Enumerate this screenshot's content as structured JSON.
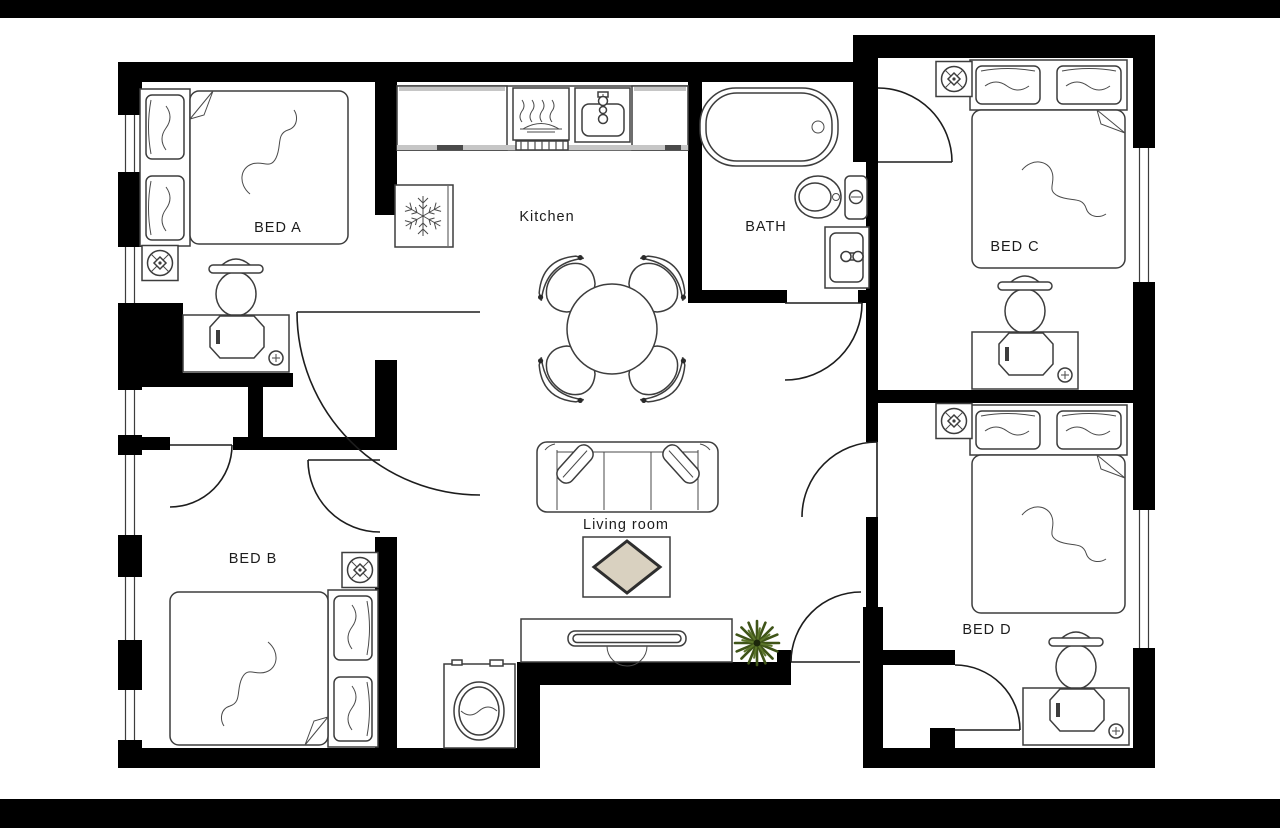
{
  "title": "Apartment floor plan",
  "rooms": {
    "bed_a": {
      "label": "BED A"
    },
    "bed_b": {
      "label": "BED B"
    },
    "bed_c": {
      "label": "BED C"
    },
    "bed_d": {
      "label": "BED D"
    },
    "kitchen": {
      "label": "Kitchen"
    },
    "bath": {
      "label": "BATH"
    },
    "living": {
      "label": "Living room"
    }
  },
  "icons": {
    "snowflake": "refrigerator / freezer symbol",
    "ceiling_fan": "ceiling fan symbol",
    "power_outlet": "outlet cross-in-circle symbol",
    "door_arc": "door swing quarter-arc symbol"
  },
  "colors": {
    "wall": "#000000",
    "letterbox": "#000000",
    "background": "#ffffff",
    "line": "#3d3d3d",
    "rug": "#d9d1c0",
    "plant_dark": "#3f5418",
    "plant_light": "#5b752a"
  }
}
